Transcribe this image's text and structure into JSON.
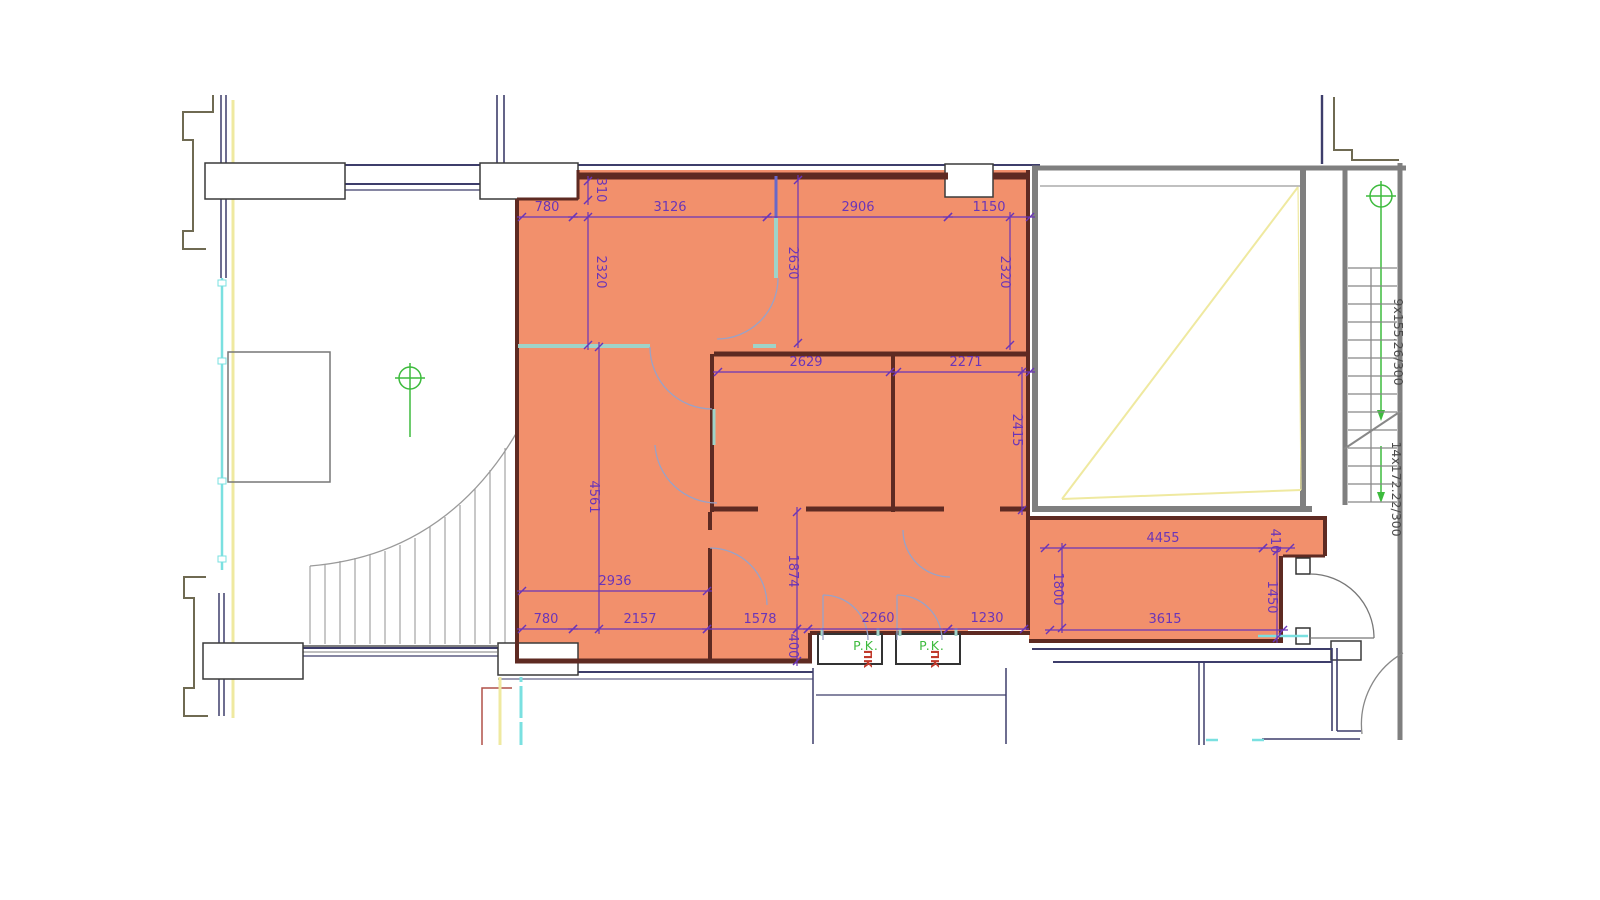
{
  "document": {
    "type": "architectural-floor-plan",
    "highlighted_unit": "two-room apartment highlighted in orange"
  },
  "colors": {
    "highlight_fill": "#f2906c",
    "interior_wall": "#5e2a22",
    "dimension": "#6a35b8",
    "teal_partition": "#9fd3c8",
    "cyan_line": "#7ae0e0",
    "yellow_line": "#efe9a0",
    "green_marker": "#3dbb3d",
    "red_label": "#c0392b",
    "gray_wall": "#7f7f7f",
    "navy_wall": "#3d3d6b",
    "olive_outline": "#6f6a52"
  },
  "stairs": {
    "upper_label": "9x155.26/300",
    "lower_label": "14x172.22/300"
  },
  "vents": [
    {
      "label": "P.K.",
      "sub": "ПК"
    },
    {
      "label": "P.K.",
      "sub": "ПК"
    }
  ],
  "dimensions": [
    {
      "label": "780",
      "x1": 522,
      "y1": 217,
      "x2": 573,
      "y2": 217,
      "tx": 547,
      "ty": 211,
      "rot": 0
    },
    {
      "label": "3126",
      "x1": 573,
      "y1": 217,
      "x2": 767,
      "y2": 217,
      "tx": 670,
      "ty": 211,
      "rot": 0
    },
    {
      "label": "2906",
      "x1": 767,
      "y1": 217,
      "x2": 948,
      "y2": 217,
      "tx": 858,
      "ty": 211,
      "rot": 0
    },
    {
      "label": "1150",
      "x1": 948,
      "y1": 217,
      "x2": 1030,
      "y2": 217,
      "tx": 989,
      "ty": 211,
      "rot": 0
    },
    {
      "label": "310",
      "x1": 588,
      "y1": 181,
      "x2": 588,
      "y2": 200,
      "tx": 597,
      "ty": 190,
      "rot": 90
    },
    {
      "label": "2320",
      "x1": 588,
      "y1": 217,
      "x2": 588,
      "y2": 345,
      "tx": 597,
      "ty": 272,
      "rot": 90
    },
    {
      "label": "2630",
      "x1": 798,
      "y1": 180,
      "x2": 798,
      "y2": 343,
      "tx": 789,
      "ty": 263,
      "rot": 90
    },
    {
      "label": "2320",
      "x1": 1010,
      "y1": 217,
      "x2": 1010,
      "y2": 345,
      "tx": 1001,
      "ty": 272,
      "rot": 90
    },
    {
      "label": "2629",
      "x1": 718,
      "y1": 372,
      "x2": 890,
      "y2": 372,
      "tx": 806,
      "ty": 366,
      "rot": 0
    },
    {
      "label": "2271",
      "x1": 897,
      "y1": 372,
      "x2": 1030,
      "y2": 372,
      "tx": 966,
      "ty": 366,
      "rot": 0
    },
    {
      "label": "2415",
      "x1": 1022,
      "y1": 372,
      "x2": 1022,
      "y2": 510,
      "tx": 1013,
      "ty": 430,
      "rot": 90
    },
    {
      "label": "4561",
      "x1": 599,
      "y1": 347,
      "x2": 599,
      "y2": 629,
      "tx": 590,
      "ty": 497,
      "rot": 90
    },
    {
      "label": "2936",
      "x1": 522,
      "y1": 591,
      "x2": 707,
      "y2": 591,
      "tx": 615,
      "ty": 585,
      "rot": 0
    },
    {
      "label": "780",
      "x1": 522,
      "y1": 629,
      "x2": 573,
      "y2": 629,
      "tx": 546,
      "ty": 623,
      "rot": 0
    },
    {
      "label": "2157",
      "x1": 573,
      "y1": 629,
      "x2": 707,
      "y2": 629,
      "tx": 640,
      "ty": 623,
      "rot": 0
    },
    {
      "label": "1578",
      "x1": 707,
      "y1": 629,
      "x2": 808,
      "y2": 629,
      "tx": 760,
      "ty": 623,
      "rot": 0
    },
    {
      "label": "2260",
      "x1": 808,
      "y1": 629,
      "x2": 948,
      "y2": 629,
      "tx": 878,
      "ty": 622,
      "rot": 0
    },
    {
      "label": "1230",
      "x1": 948,
      "y1": 629,
      "x2": 1024,
      "y2": 629,
      "tx": 987,
      "ty": 622,
      "rot": 0
    },
    {
      "label": "1874",
      "x1": 797,
      "y1": 512,
      "x2": 797,
      "y2": 629,
      "tx": 789,
      "ty": 571,
      "rot": 90
    },
    {
      "label": "400",
      "x1": 797,
      "y1": 629,
      "x2": 797,
      "y2": 661,
      "tx": 789,
      "ty": 646,
      "rot": 90
    },
    {
      "label": "4455",
      "x1": 1045,
      "y1": 548,
      "x2": 1263,
      "y2": 548,
      "tx": 1163,
      "ty": 542,
      "rot": 0
    },
    {
      "label": "410",
      "x1": 1263,
      "y1": 548,
      "x2": 1290,
      "y2": 548,
      "tx": 1271,
      "ty": 541,
      "rot": 90
    },
    {
      "label": "1800",
      "x1": 1062,
      "y1": 548,
      "x2": 1062,
      "y2": 628,
      "tx": 1054,
      "ty": 589,
      "rot": 90
    },
    {
      "label": "1450",
      "x1": 1277,
      "y1": 551,
      "x2": 1277,
      "y2": 638,
      "tx": 1268,
      "ty": 597,
      "rot": 90
    },
    {
      "label": "3615",
      "x1": 1050,
      "y1": 630,
      "x2": 1283,
      "y2": 630,
      "tx": 1165,
      "ty": 623,
      "rot": 0
    }
  ]
}
